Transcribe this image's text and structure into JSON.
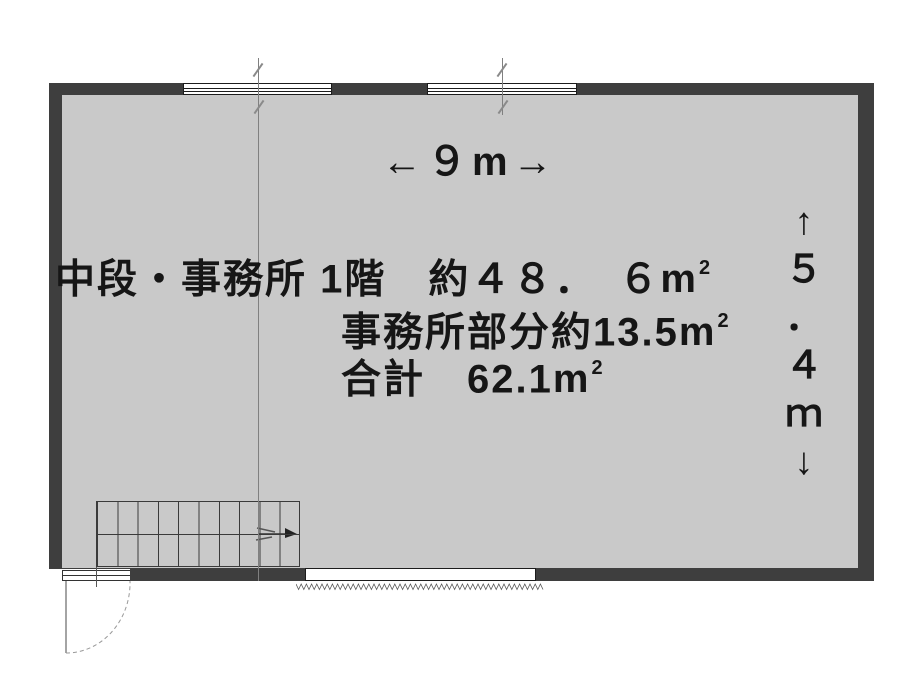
{
  "colors": {
    "wall": "#3e3e3e",
    "floor": "#c9c9c9",
    "line": "#808080",
    "ink": "#161616"
  },
  "labels": {
    "main": {
      "text": "中段・事務所 1階　約４８．　６",
      "unit_base": "m",
      "unit_exp": "2"
    },
    "office": {
      "text": "事務所部分約13.5",
      "unit_base": "m",
      "unit_exp": "2"
    },
    "total": {
      "text": "合計　62.1",
      "unit_base": "m",
      "unit_exp": "2"
    }
  },
  "dimensions": {
    "width_label": "←９m→",
    "height_label_chars": [
      "↑",
      "５",
      "．",
      "４",
      "ｍ",
      "↓"
    ]
  }
}
